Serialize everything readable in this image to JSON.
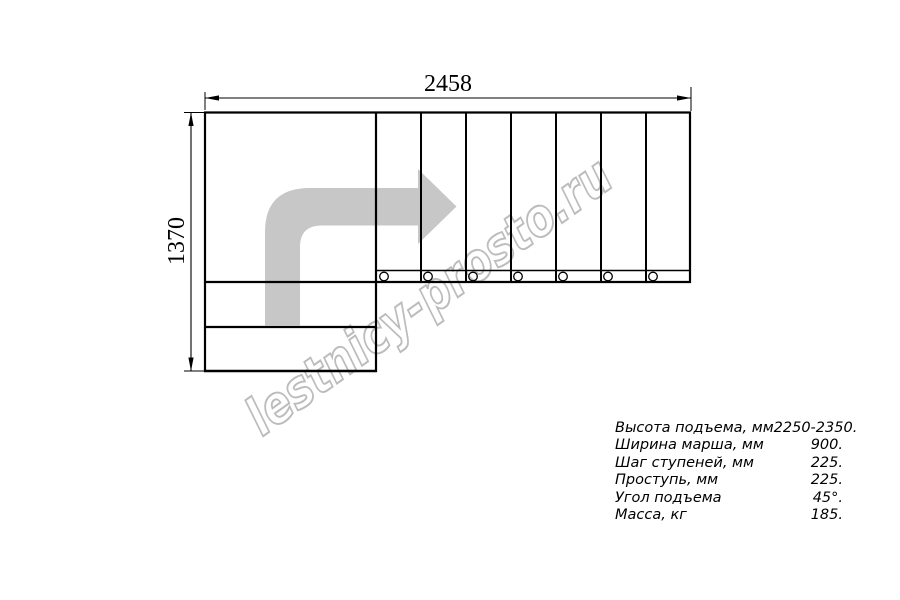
{
  "drawing": {
    "width_dimension": "2458",
    "height_dimension": "1370",
    "watermark": "lestnicy-prosto.ru",
    "arrow_color": "#c7c7c7",
    "watermark_color": "#bcbcbc",
    "line_color": "#000000"
  },
  "specs": {
    "rows": [
      {
        "label": "Высота подъема, мм",
        "value": "2250-2350."
      },
      {
        "label": "Ширина марша, мм",
        "value": "900."
      },
      {
        "label": "Шаг ступеней, мм",
        "value": "225."
      },
      {
        "label": "Проступь, мм",
        "value": "225."
      },
      {
        "label": "Угол подъема",
        "value": "45°."
      },
      {
        "label": "Масса, кг",
        "value": "185."
      }
    ]
  }
}
